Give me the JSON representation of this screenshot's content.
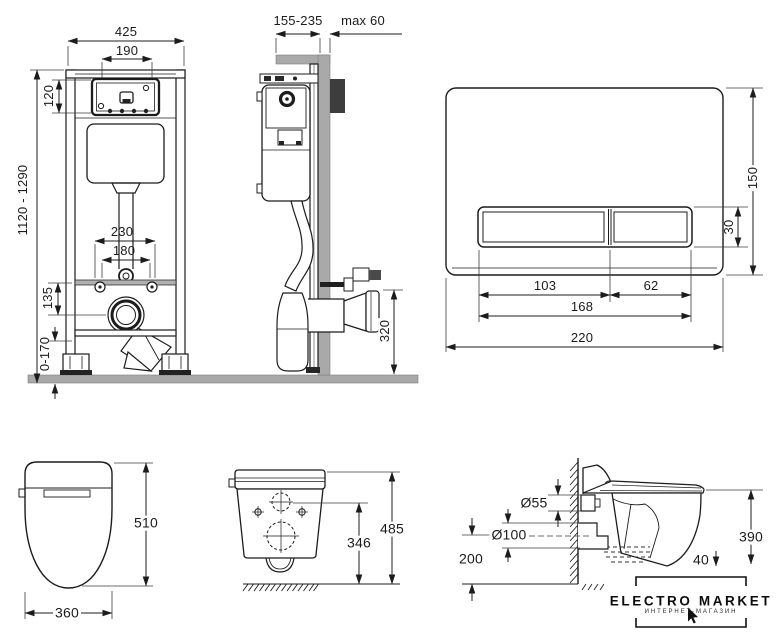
{
  "colors": {
    "line": "#1c1c1c",
    "wall_gray": "#a9a9a9",
    "bracket_dark": "#3d3d3d"
  },
  "views": {
    "frame_front": {
      "dims": {
        "total_width": "425",
        "window_width": "190",
        "window_height": "120",
        "height_range": "1120 - 1290",
        "fixing_outer": "230",
        "fixing_inner": "180",
        "drain_offset": "135",
        "foot_adjust": "0-170"
      }
    },
    "frame_side": {
      "dims": {
        "depth_range": "155-235",
        "wall_max": "max 60",
        "outlet_height": "320"
      }
    },
    "flush_plate": {
      "dims": {
        "height": "150",
        "button_height": "30",
        "button_left": "103",
        "button_right": "62",
        "buttons_width": "168",
        "width": "220"
      }
    },
    "bowl_top": {
      "dims": {
        "length": "510",
        "width": "360"
      }
    },
    "bowl_back": {
      "dims": {
        "inlet_height": "346",
        "total_height": "485"
      }
    },
    "bowl_side": {
      "dims": {
        "inlet_diameter": "Ø55",
        "outlet_diameter": "Ø100",
        "outlet_height": "200",
        "rim_height": "390",
        "drop": "40"
      }
    }
  },
  "brand": {
    "name": "ELECTRO MARKET",
    "subtitle": "ИНТЕРНЕТ-МАГАЗИН"
  }
}
